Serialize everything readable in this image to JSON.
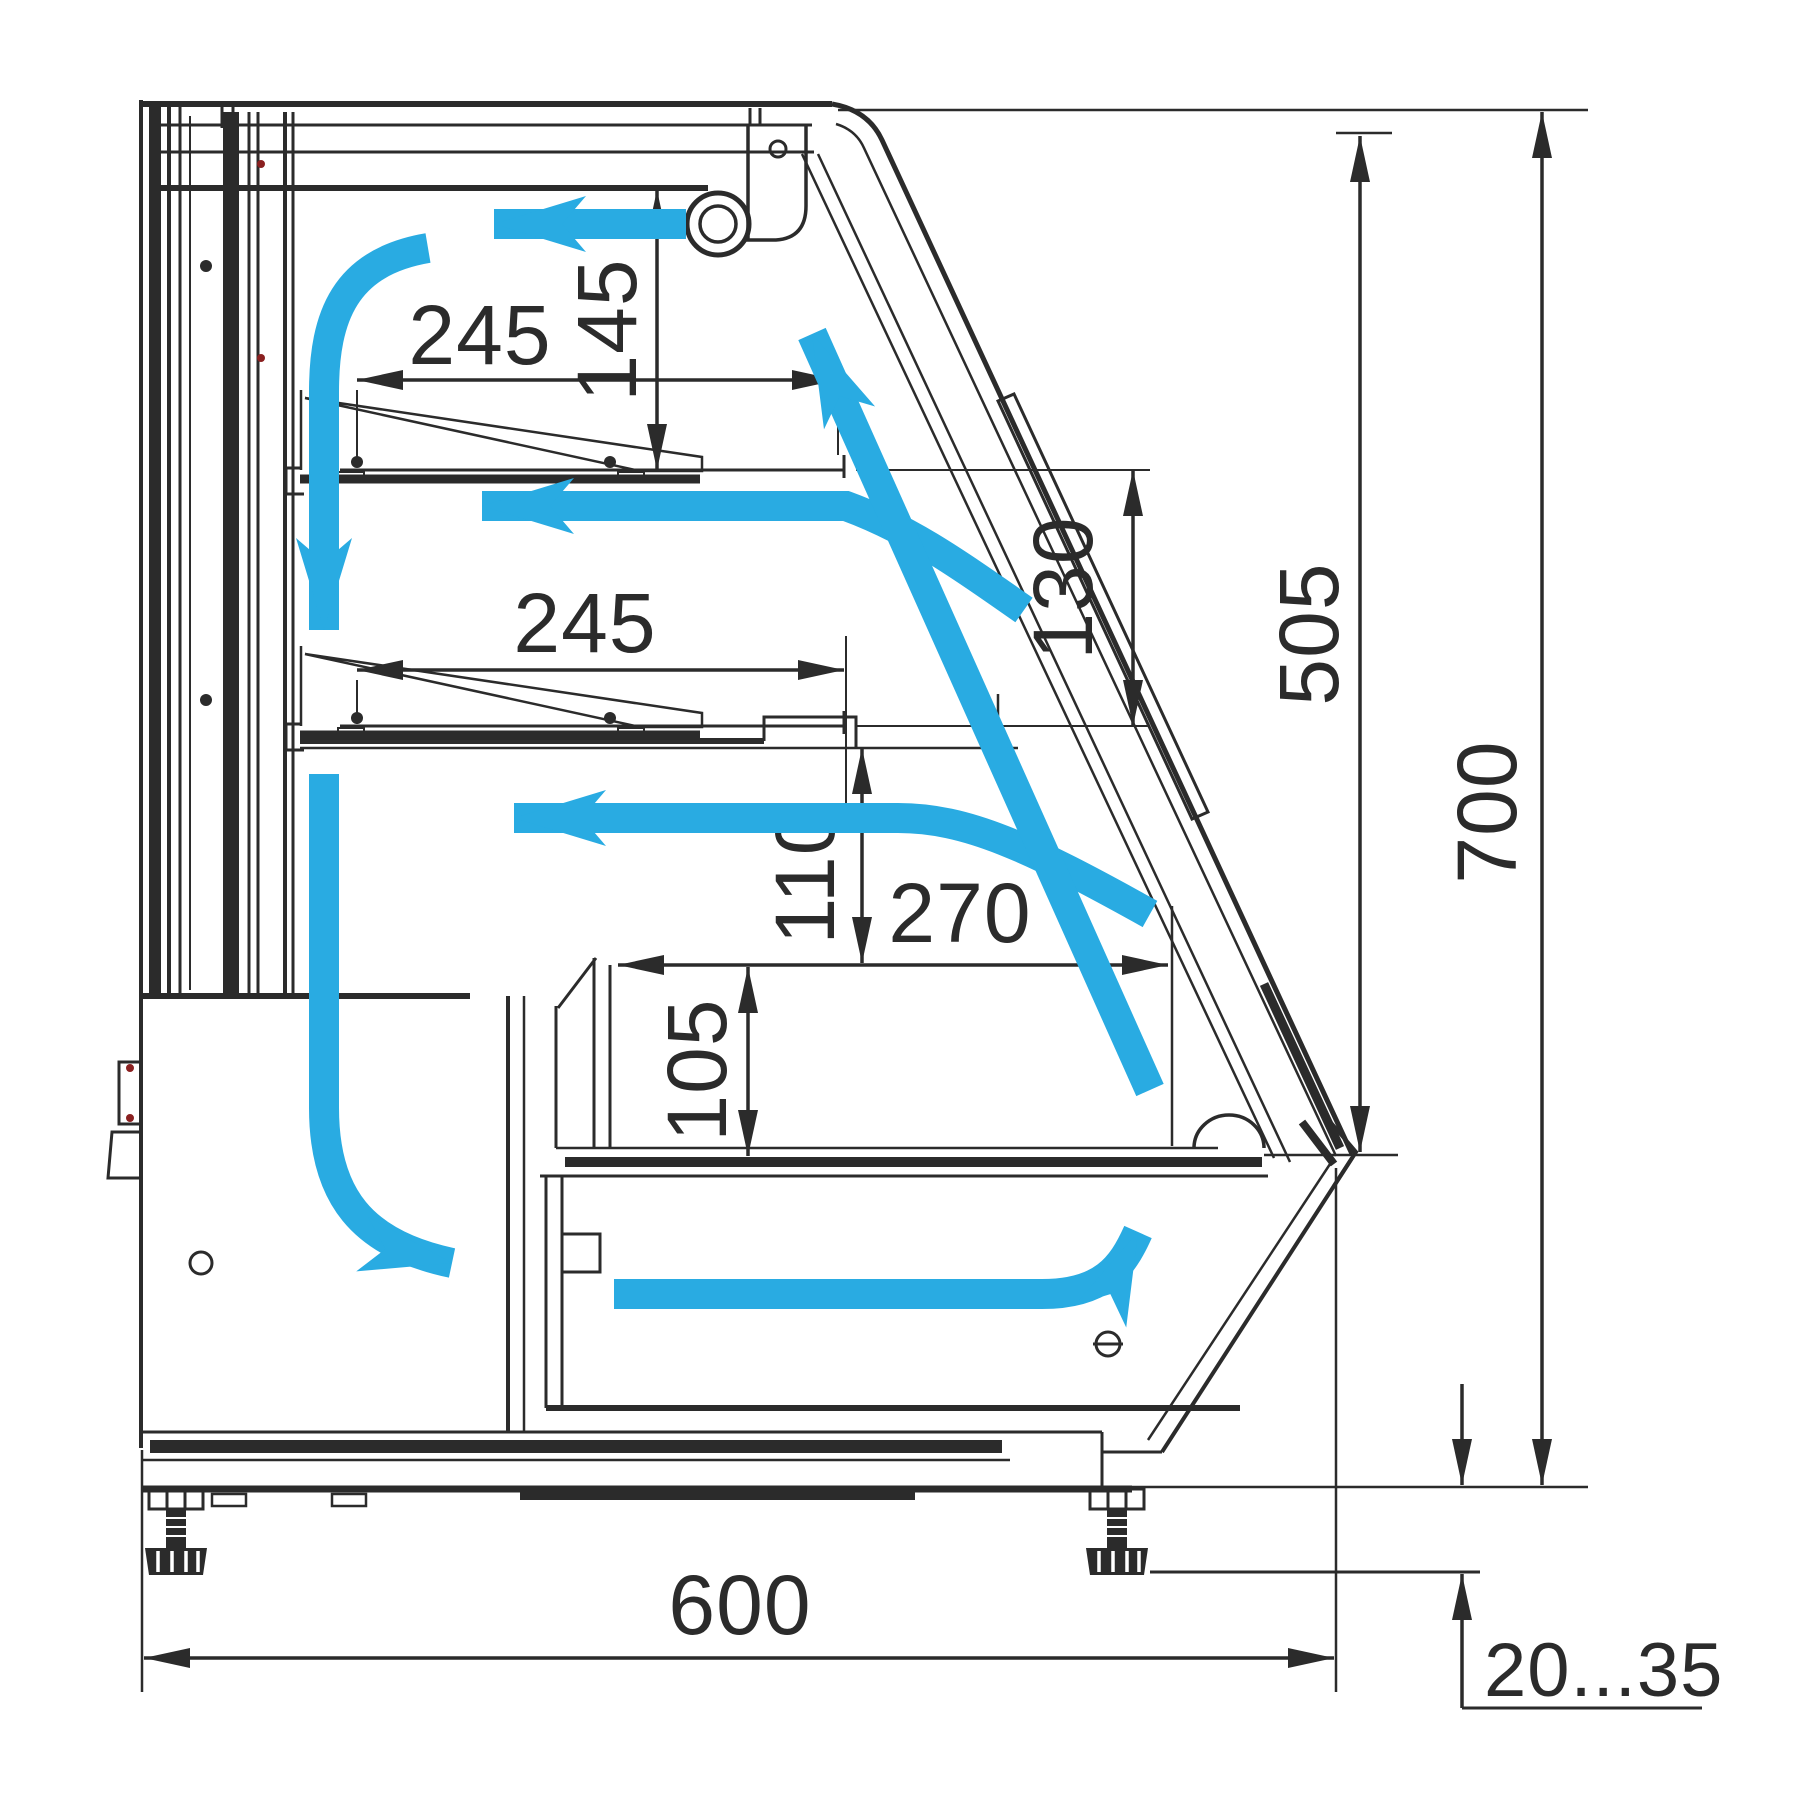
{
  "drawing": {
    "description": "Refrigerated display case side cross-section with airflow circulation and dimensions",
    "units": "mm",
    "colors": {
      "line": "#2b2b2b",
      "airflow": "#29abe2",
      "background": "#ffffff",
      "accent_red": "#8a2020"
    },
    "dims": {
      "shelf_top_depth": "245",
      "top_gap": "145",
      "shelf_mid_depth": "245",
      "shelf_spacing": "130",
      "glass_height": "505",
      "total_height": "700",
      "deck_gap": "110",
      "well_width": "270",
      "well_depth": "105",
      "total_depth": "600",
      "leg_height_range": "20...35"
    }
  }
}
